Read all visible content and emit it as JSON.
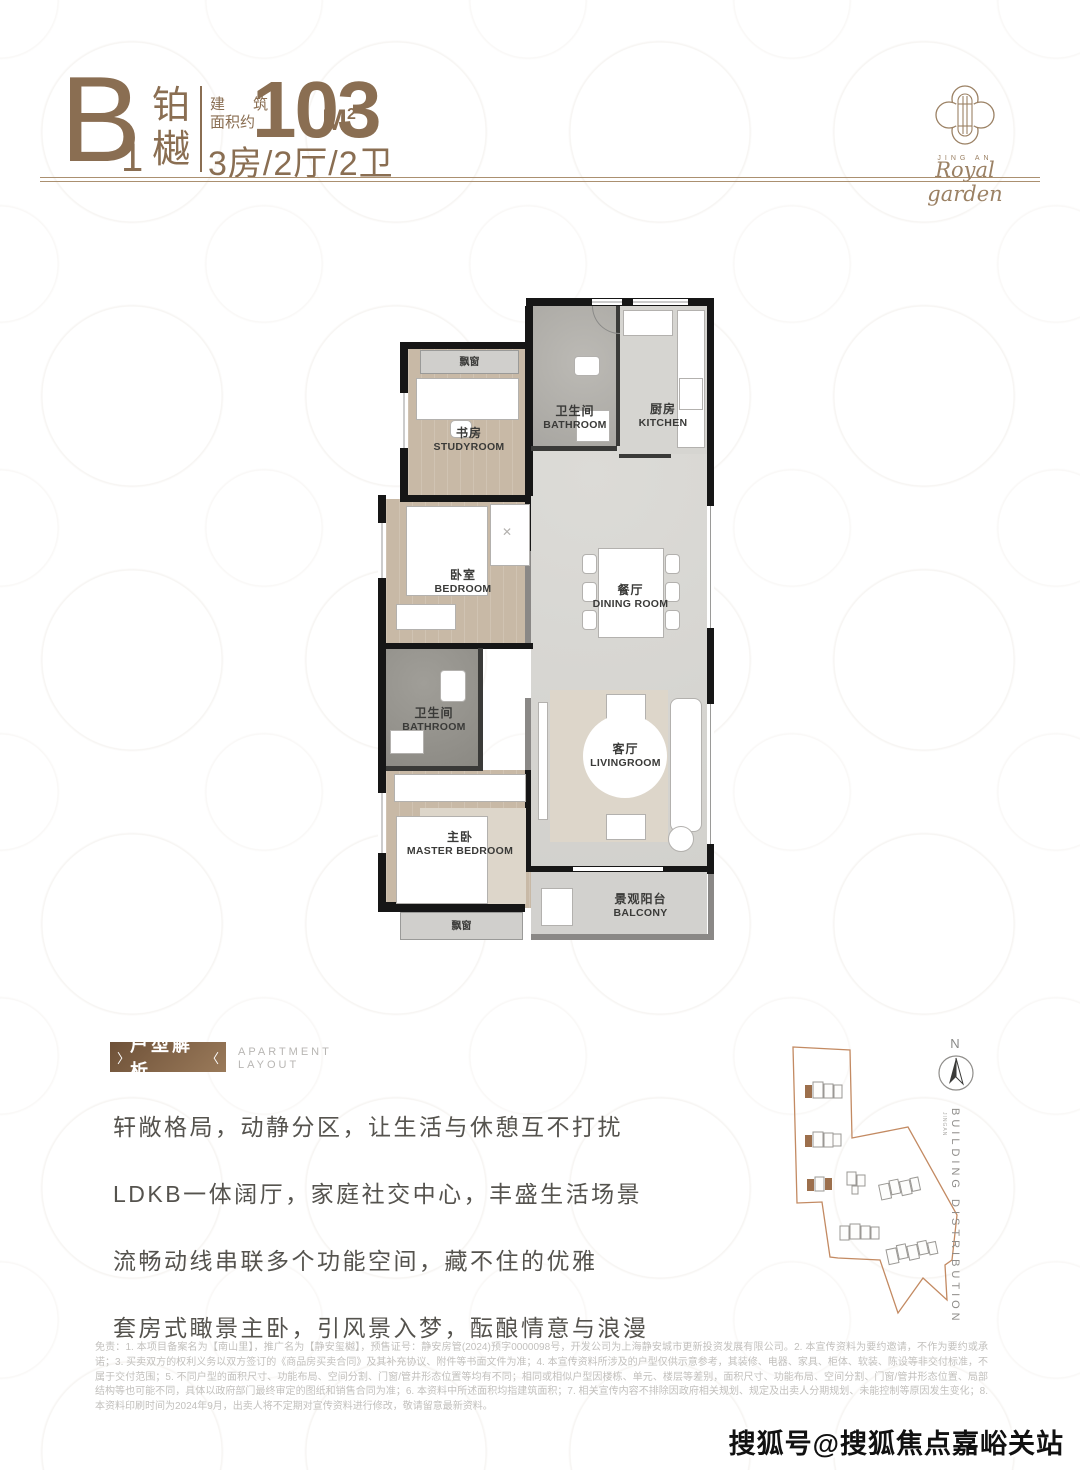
{
  "header": {
    "unit_letter": "B",
    "unit_number": "1",
    "unit_name_char1": "铂",
    "unit_name_char2": "樾",
    "area_label_line1_a": "建",
    "area_label_line1_b": "筑",
    "area_label_line2": "面积约",
    "area_value": "103",
    "area_unit": "M",
    "area_unit_sup": "2",
    "layout_spec": "3房/2厅/2卫"
  },
  "logo": {
    "brand_top": "JING AN",
    "brand_script": "Royal garden"
  },
  "floorplan": {
    "bay_window_top": "飘窗",
    "bay_window_bottom": "飘窗",
    "rooms": [
      {
        "cn": "书房",
        "en": "STUDYROOM"
      },
      {
        "cn": "卫生间",
        "en": "BATHROOM"
      },
      {
        "cn": "厨房",
        "en": "KITCHEN"
      },
      {
        "cn": "卧室",
        "en": "BEDROOM"
      },
      {
        "cn": "餐厅",
        "en": "DINING ROOM"
      },
      {
        "cn": "卫生间",
        "en": "BATHROOM"
      },
      {
        "cn": "主卧",
        "en": "MASTER BEDROOM"
      },
      {
        "cn": "客厅",
        "en": "LIVINGROOM"
      },
      {
        "cn": "景观阳台",
        "en": "BALCONY"
      }
    ]
  },
  "section": {
    "badge": "户型解析",
    "badge_mark_left": "〉",
    "badge_mark_right": "〈",
    "subtitle_line1": "APARTMENT",
    "subtitle_line2": "LAYOUT",
    "paragraph_lines": [
      "轩敞格局，动静分区，让生活与休憩互不打扰",
      "LDKB一体阔厅，家庭社交中心，丰盛生活场景",
      "流畅动线串联多个功能空间，藏不住的优雅",
      "套房式瞰景主卧，引风景入梦，酝酿情意与浪漫"
    ]
  },
  "siteplan": {
    "north_label": "N",
    "axis_label": "BUILDING DISTRIBUTION",
    "axis_sub": "JINGAN"
  },
  "disclaimer": "免责：1. 本项目备案名为【南山里】，推广名为【静安玺樾】，预售证号：静安房管(2024)预字0000098号，开发公司为上海静安城市更新投资发展有限公司。2. 本宣传资料为要约邀请，不作为要约或承诺；3. 买卖双方的权利义务以双方签订的《商品房买卖合同》及其补充协议、附件等书面文件为准；4. 本宣传资料所涉及的户型仅供示意参考，其装修、电器、家具、柜体、软装、陈设等非交付标准，不属于交付范围；5. 不同户型的面积尺寸、功能布局、空间分割、门窗/管井形态位置等均有不同；相同或相似户型因楼栋、单元、楼层等差别，面积尺寸、功能布局、空间分割、门窗/管井形态位置、局部结构等也可能不同，具体以政府部门最终审定的图纸和销售合同为准；6. 本资料中所述面积均指建筑面积；7. 相关宣传内容不排除因政府相关规划、规定及出卖人分期规划、未能控制等原因发生变化；8. 本资料印刷时间为2024年9月，出卖人将不定期对宣传资料进行修改，敬请留意最新资料。",
  "watermark": "搜狐号@搜狐焦点嘉峪关站",
  "colors": {
    "brand_brown": "#8a6e52",
    "rule_brown": "#ab9070",
    "badge_brown": "#7d6147",
    "site_outline": "#c38a62",
    "wall_black": "#161616",
    "wood_floor": "#c8b9a6",
    "marble_gray": "#d8d7d3"
  }
}
